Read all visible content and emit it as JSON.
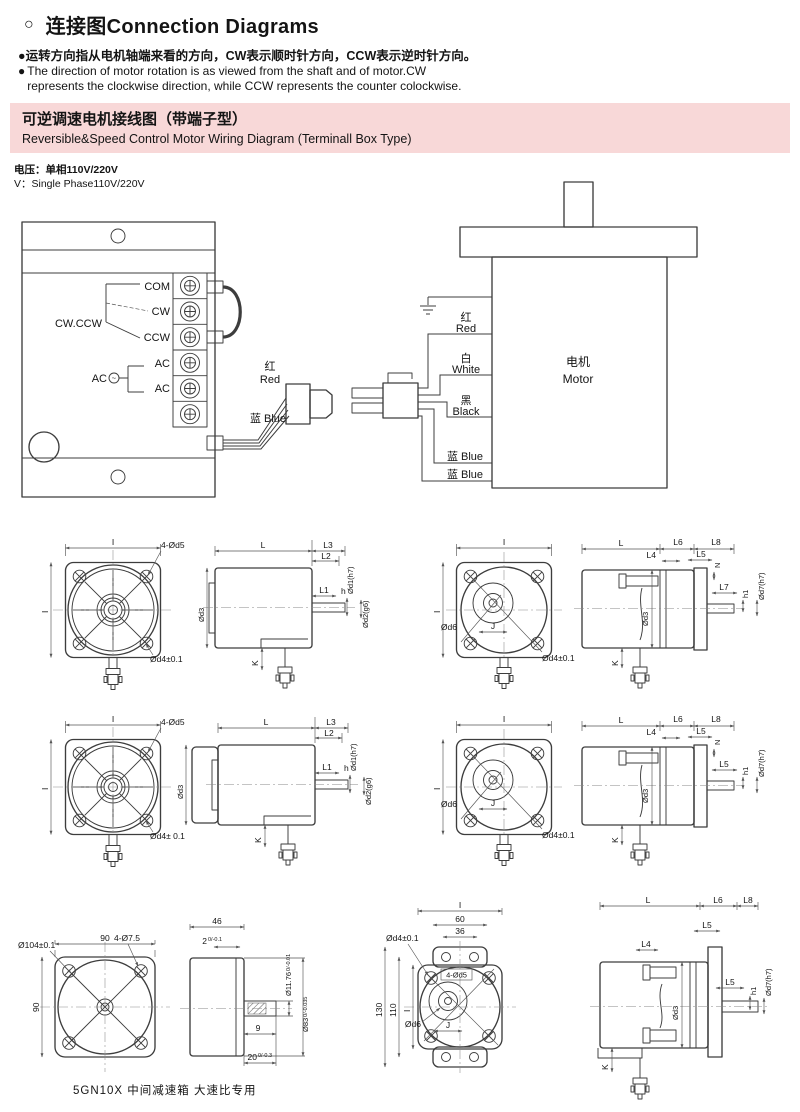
{
  "header": {
    "marker": "○",
    "bullet": "●",
    "title": "连接图Connection Diagrams",
    "note_cn": "运转方向指从电机轴端来看的方向，CW表示顺时针方向，CCW表示逆时针方向。",
    "note_en_line1": "The direction of motor rotation is as viewed from the shaft and of motor.CW",
    "note_en_line2": "represents the clockwise direction, while CCW represents the counter colockwise."
  },
  "banner": {
    "title_cn": "可逆调速电机接线图（带端子型）",
    "title_en": "Reversible&Speed Control Motor Wiring Diagram (Terminall Box Type)",
    "bg_color": "#f8d8d8"
  },
  "voltage": {
    "cn": "电压：单相110V/220V",
    "en": "V：Single Phase110V/220V"
  },
  "controller": {
    "terminal_labels": [
      "COM",
      "CW",
      "CCW",
      "AC",
      "AC"
    ],
    "selector_label": "CW.CCW",
    "ac_label": "AC",
    "ac_symbol": "~",
    "wire_red_cn": "红",
    "wire_red_en": "Red",
    "wire_blue": "蓝 Blue"
  },
  "motor": {
    "name_cn": "电机",
    "name_en": "Motor",
    "wire1_cn": "红",
    "wire1_en": "Red",
    "wire2_cn": "白",
    "wire2_en": "White",
    "wire3_cn": "黑",
    "wire3_en": "Black",
    "wire4": "蓝 Blue",
    "wire5": "蓝 Blue"
  },
  "drawings": {
    "r1l": {
      "i_top": "I",
      "i_left": "I",
      "holes": "4-Ød5",
      "d4": "Ød4±0.1",
      "L": "L",
      "L3": "L3",
      "L2": "L2",
      "L1": "L1",
      "h": "h",
      "d1": "Ød1(h7)",
      "d2": "Ød2(g6)",
      "d3": "Ød3",
      "K": "K"
    },
    "r1r": {
      "i_top": "I",
      "i_left": "I",
      "d6": "Ød6",
      "J": "J",
      "d4": "Ød4±0.1",
      "L": "L",
      "L6": "L6",
      "L8": "L8",
      "L4": "L4",
      "L5": "L5",
      "N": "N",
      "L7": "L7",
      "h1": "h1",
      "d7": "Ød7(h7)",
      "d3": "Ød3",
      "K": "K"
    },
    "r2l": {
      "i_top": "I",
      "i_left": "I",
      "holes": "4-Ød5",
      "d4": "Ød4± 0.1",
      "L": "L",
      "L3": "L3",
      "L2": "L2",
      "L1": "L1",
      "h": "h",
      "d1": "Ød1(h7)",
      "d2": "Ød2(g6)",
      "d3": "Ød3",
      "K": "K"
    },
    "r2r": {
      "i_top": "I",
      "i_left": "I",
      "d6": "Ød6",
      "J": "J",
      "d4": "Ød4±0.1",
      "L": "L",
      "L6": "L6",
      "L8": "L8",
      "L4": "L4",
      "L5a": "L5",
      "N": "N",
      "L5b": "L5",
      "h1": "h1",
      "d7": "Ød7(h7)",
      "d3": "Ød3",
      "K": "K"
    },
    "r3l": {
      "top": "90",
      "left": "90",
      "holes": "4-Ø7.5",
      "flange": "Ø104±0.1",
      "width": "46",
      "step": "2",
      "step_tol": "0/-0.1",
      "shaft_d": "Ø11.76",
      "shaft_d_tol": "0/-0.01",
      "body_d": "Ø83",
      "body_d_tol": "0/-0.035",
      "key_len": "9",
      "shaft_len": "20",
      "shaft_len_tol": "0/-0.3"
    },
    "r3r": {
      "i_top": "I",
      "d60": "60",
      "d36": "36",
      "d130": "130",
      "d110": "110",
      "i_left": "I",
      "d4": "Ød4±0.1",
      "holes": "4-Ød5",
      "d6": "Ød6",
      "J": "J",
      "L": "L",
      "L6": "L6",
      "L8": "L8",
      "L5a": "L5",
      "L4": "L4",
      "L5b": "L5",
      "h1": "h1",
      "d7": "Ød7(h7)",
      "d3": "Ød3",
      "K": "K"
    }
  },
  "caption": "5GN10X 中间减速箱 大速比专用"
}
